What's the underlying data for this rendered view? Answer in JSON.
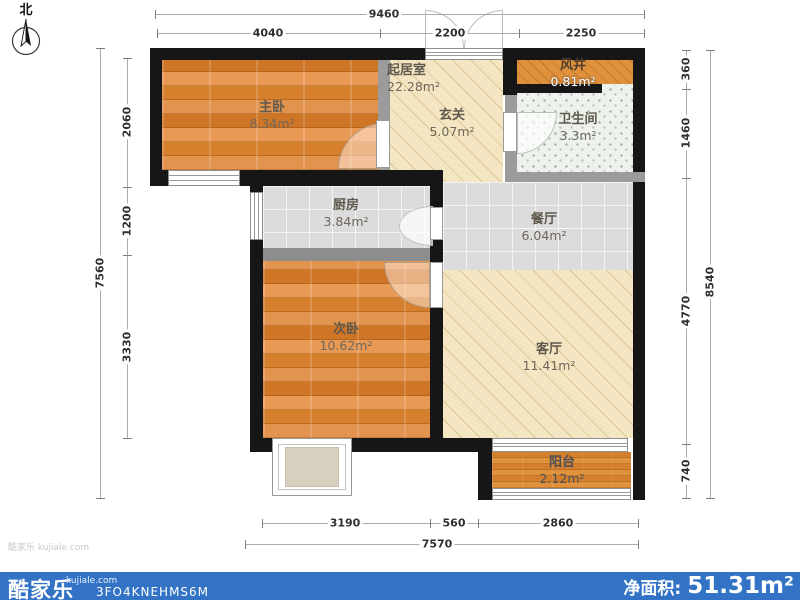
{
  "meta": {
    "compass_label": "北",
    "watermark": "酷家乐 kujiale.com"
  },
  "rooms": {
    "master_bedroom": {
      "name": "主卧",
      "area": "8.34m²"
    },
    "hall": {
      "name": "起居室",
      "area": "22.28m²"
    },
    "entry": {
      "name": "玄关",
      "area": "5.07m²"
    },
    "air_shaft": {
      "name": "风井",
      "area": "0.81m²"
    },
    "bathroom": {
      "name": "卫生间",
      "area": "3.3m²"
    },
    "kitchen": {
      "name": "厨房",
      "area": "3.84m²"
    },
    "dining": {
      "name": "餐厅",
      "area": "6.04m²"
    },
    "second_bedroom": {
      "name": "次卧",
      "area": "10.62m²"
    },
    "living": {
      "name": "客厅",
      "area": "11.41m²"
    },
    "balcony": {
      "name": "阳台",
      "area": "2.12m²"
    }
  },
  "dimensions": {
    "top": {
      "total": "9460",
      "segments": [
        "4040",
        "2200",
        "2250"
      ]
    },
    "left": {
      "total": "7560",
      "segments": [
        "2060",
        "1200",
        "3330"
      ]
    },
    "right": {
      "total": "8540",
      "segments": [
        "360",
        "1460",
        "4770",
        "740"
      ]
    },
    "bottom": {
      "total": "7570",
      "segments": [
        "3190",
        "560",
        "2860"
      ]
    }
  },
  "footer": {
    "brand": "酷家乐",
    "brand_site": "kujiale.com",
    "plan_code": "3FO4KNEHMS6M",
    "net_area_label": "净面积:",
    "net_area_value": "51.31m²"
  },
  "colors": {
    "footer_bar": "#3273c5",
    "wall": "#161616",
    "partition": "#9b9b9b",
    "wood_floor": "#d9842f",
    "cream_floor": "#f4e6c3",
    "tile_floor": "#dcdcdc",
    "bath_floor": "#eef2ec"
  }
}
